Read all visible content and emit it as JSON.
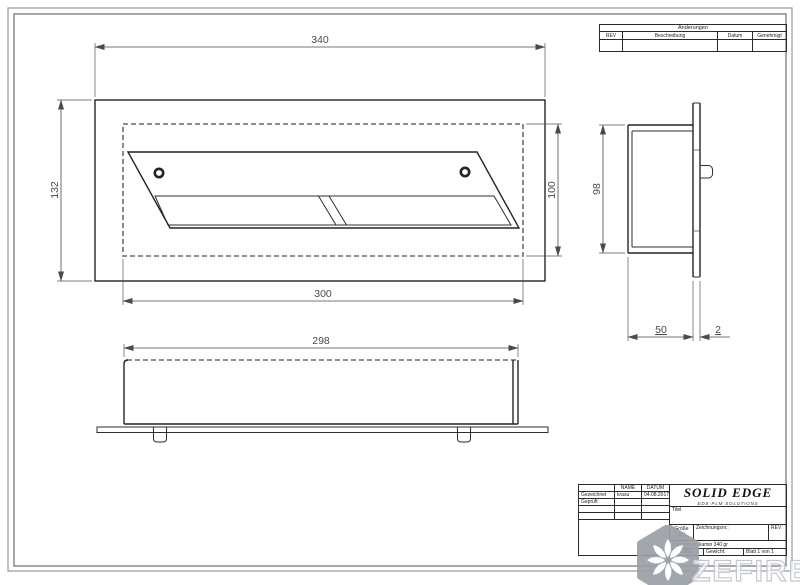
{
  "revision_table": {
    "title": "Änderungen",
    "columns": [
      "REV",
      "Beschreibung",
      "Datum",
      "Genehmigt"
    ]
  },
  "title_block": {
    "name_header": "NAME",
    "date_header": "DATUM",
    "drawn_label": "Gezeichnet",
    "drawn_name": "krasu",
    "drawn_date": "04.08.2017",
    "checked_label": "Geprüft",
    "logo": "SOLID EDGE",
    "logo_sub": "EDS-PLM SOLUTIONS",
    "title_label": "Titel",
    "size_label": "Größe",
    "size_value": "A2",
    "drawing_no_label": "Zeichnungsnr.:",
    "rev_label": "REV",
    "filename": "Dateiname: kamin 340 gr",
    "scale_label": "Maßstab:",
    "weight_label": "Gewicht:",
    "sheet_label": "Blatt 1 von 1"
  },
  "dimensions": {
    "overall_width": "340",
    "overall_height": "132",
    "opening_width": "300",
    "opening_height": "100",
    "body_width": "298",
    "body_height": "98",
    "depth": "50",
    "flange_thickness": "2"
  },
  "watermark": {
    "text": "ZEFIRE"
  },
  "colors": {
    "edge_line": "#242424",
    "hidden_line": "#7e7e7e",
    "dimension": "#4a4a4a",
    "frame": "#6d6d6d",
    "watermark_badge": "#9aa0a6",
    "watermark_text": "#c3c8ce"
  }
}
